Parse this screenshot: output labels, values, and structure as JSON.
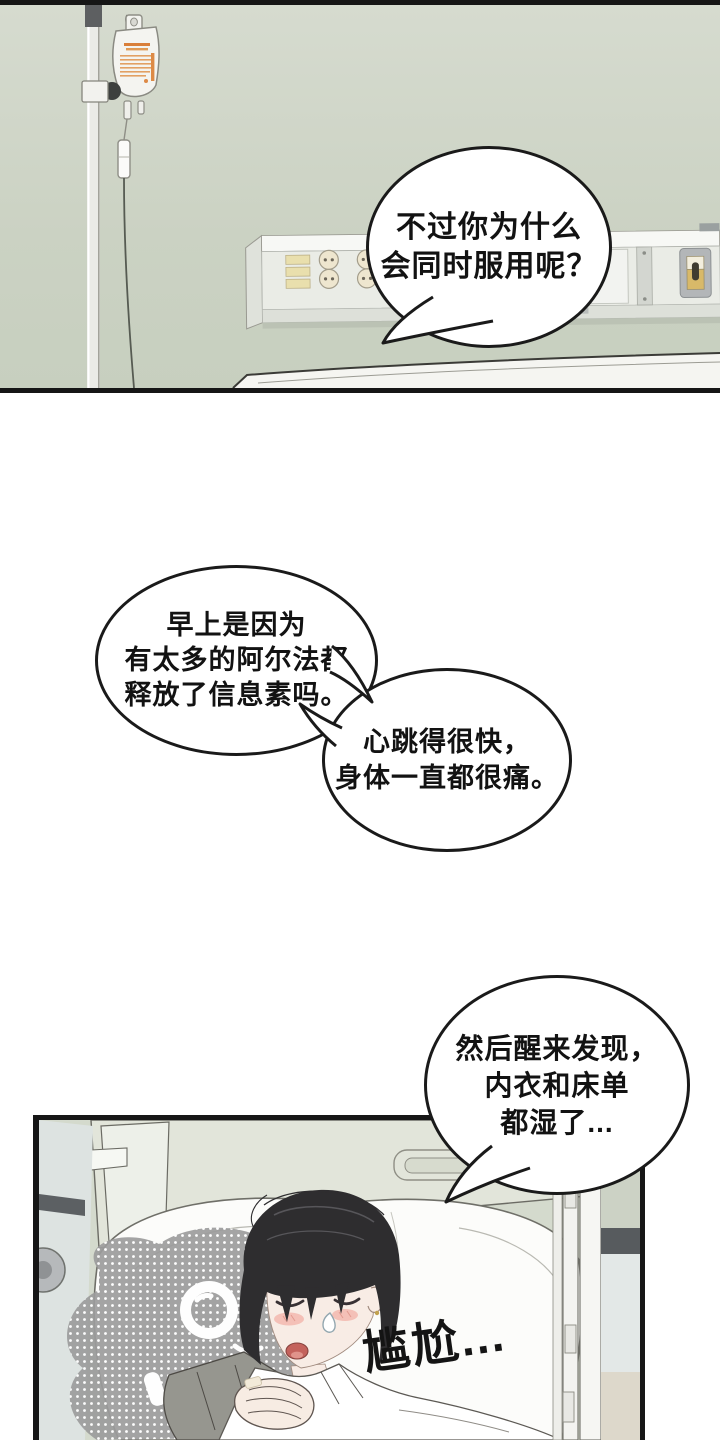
{
  "page": {
    "kind": "manhwa-comic-page",
    "background": "#ffffff"
  },
  "bubbles": [
    {
      "id": "top-right",
      "lines": [
        "不过你为什么",
        "会同时服用呢？"
      ]
    },
    {
      "id": "morning",
      "lines": [
        "早上是因为",
        "有太多的阿尔法都",
        "释放了信息素吗。"
      ]
    },
    {
      "id": "heartbeat",
      "lines": [
        "心跳得很快，",
        "身体一直都很痛。"
      ]
    },
    {
      "id": "wake-up",
      "lines": [
        "然后醒来发现，",
        "内衣和床单",
        "都湿了..."
      ]
    }
  ],
  "sfx": {
    "embarrassed": "尴尬..."
  },
  "colors": {
    "panel_border": "#161616",
    "wall_green": "#cbd2c3",
    "bubble_fill": "#ffffff",
    "bubble_stroke": "#1a1a1a",
    "iv_label_orange": "#dd8a46",
    "switch_tan": "#d8b969",
    "watermark_gray": "#9c9c9c",
    "hair": "#2e2d2f",
    "blush": "#f3b5ab"
  }
}
